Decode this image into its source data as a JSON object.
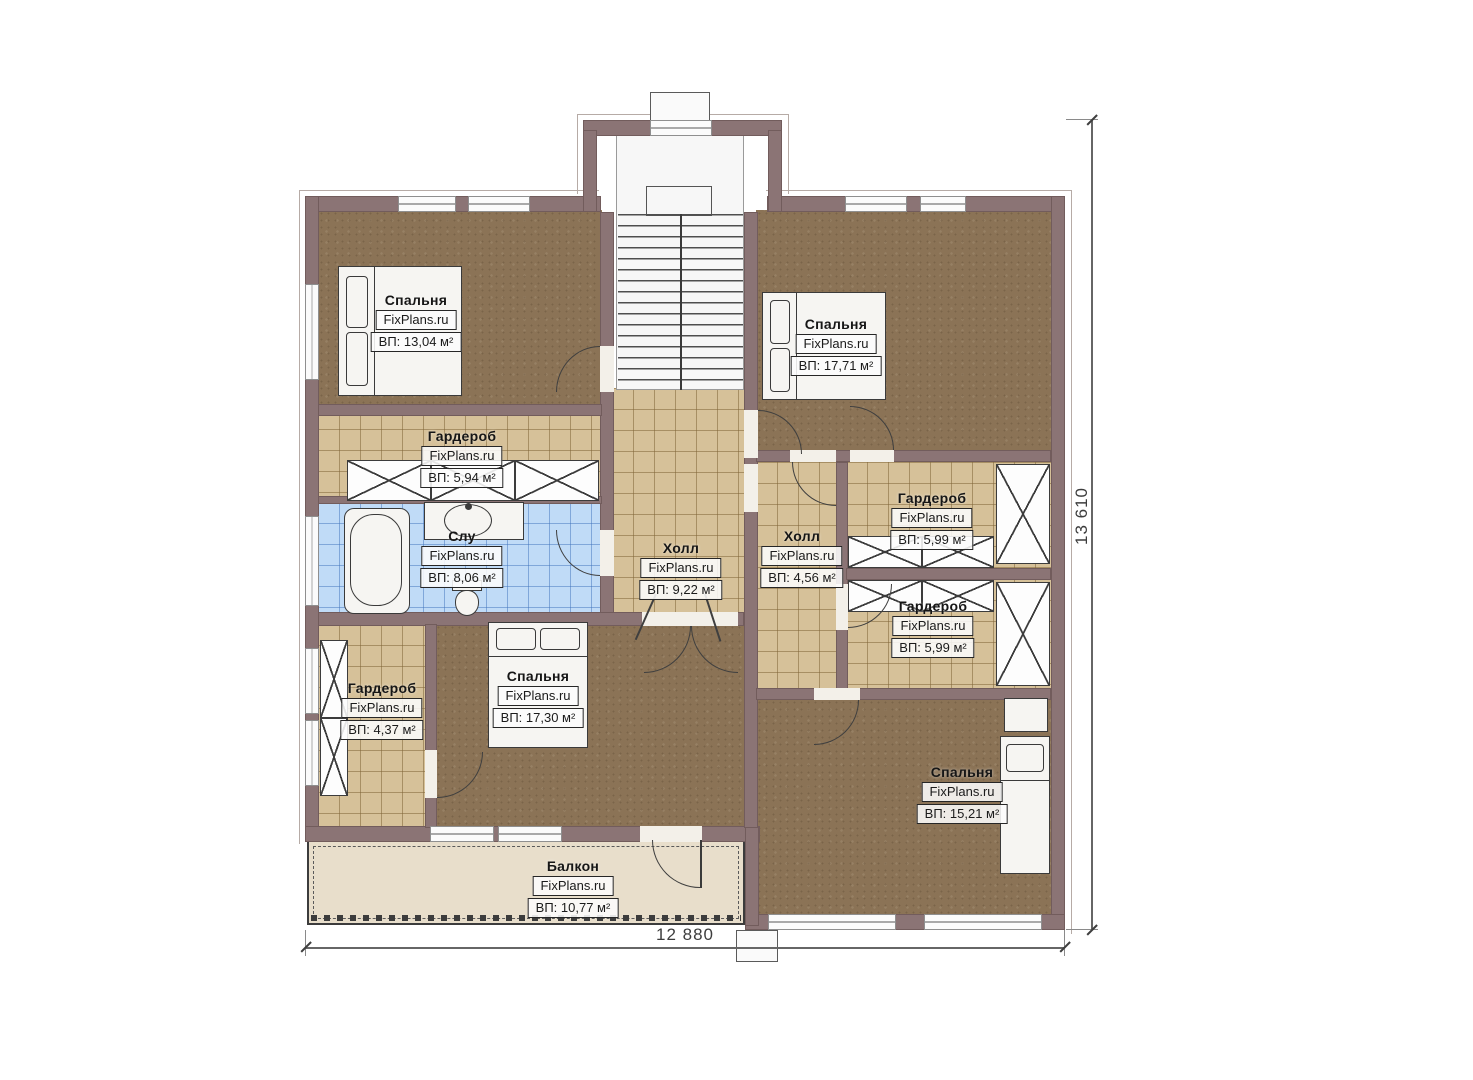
{
  "meta": {
    "type": "floor-plan",
    "brand": "FixPlans.ru"
  },
  "dimensions": {
    "bottom": "12 880",
    "right": "13 610"
  },
  "rooms": [
    {
      "key": "bedroom-top-left",
      "name": "Спальня",
      "area": "ВП: 13,04 м²"
    },
    {
      "key": "wardrobe-left",
      "name": "Гардероб",
      "area": "ВП: 5,94 м²"
    },
    {
      "key": "bathroom",
      "name": "Слу",
      "area": "ВП: 8,06 м²"
    },
    {
      "key": "hall-center",
      "name": "Холл",
      "area": "ВП: 9,22 м²"
    },
    {
      "key": "bedroom-bottom-center",
      "name": "Спальня",
      "area": "ВП: 17,30 м²"
    },
    {
      "key": "wardrobe-bottom-left",
      "name": "Гардероб",
      "area": "ВП: 4,37 м²"
    },
    {
      "key": "bedroom-top-right",
      "name": "Спальня",
      "area": "ВП: 17,71 м²"
    },
    {
      "key": "hall-right",
      "name": "Холл",
      "area": "ВП: 4,56 м²"
    },
    {
      "key": "wardrobe-right-upper",
      "name": "Гардероб",
      "area": "ВП: 5,99 м²"
    },
    {
      "key": "wardrobe-right-lower",
      "name": "Гардероб",
      "area": "ВП: 5,99 м²"
    },
    {
      "key": "bedroom-bottom-right",
      "name": "Спальня",
      "area": "ВП: 15,21 м²"
    },
    {
      "key": "balcony",
      "name": "Балкон",
      "area": "ВП: 10,77 м²"
    }
  ],
  "colors": {
    "wall": "#8b7475",
    "carpet": "#8b7356",
    "tile_tan": "#d6c199",
    "tile_blue": "#c0dbf7",
    "balcony": "#e8decb",
    "background": "#ffffff"
  }
}
